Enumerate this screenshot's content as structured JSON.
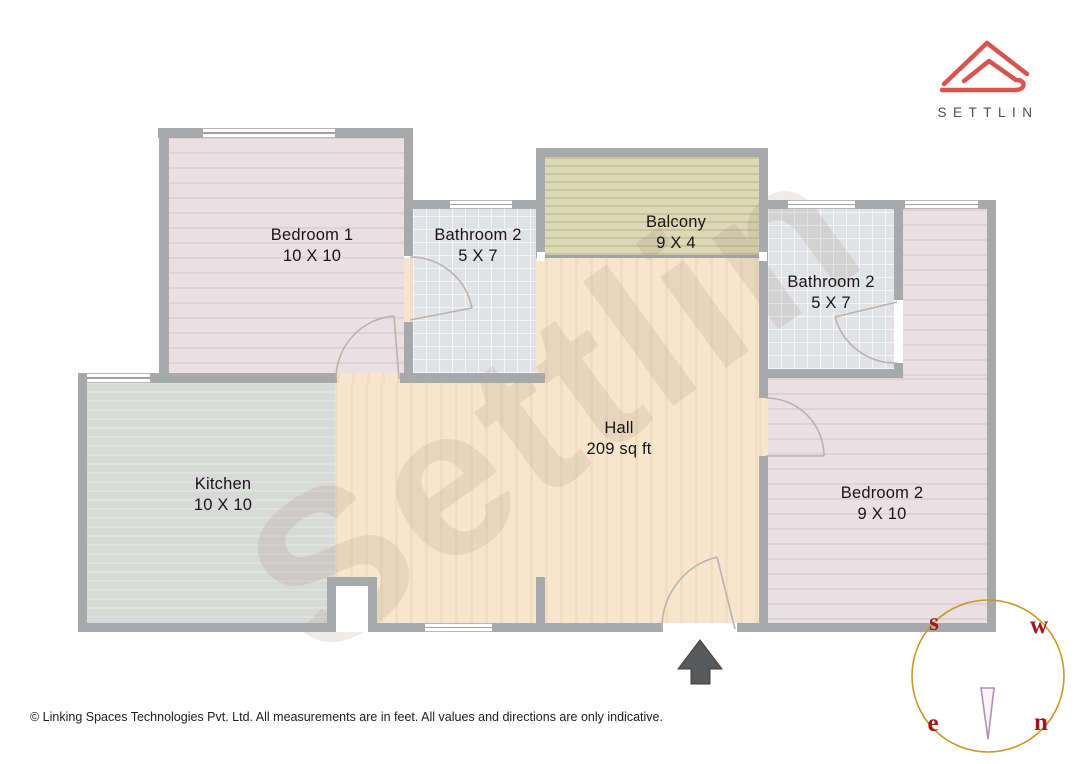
{
  "logo": {
    "brand": "SETTLIN"
  },
  "rooms": {
    "bedroom1": {
      "name": "Bedroom 1",
      "dims": "10 X 10"
    },
    "bathroom_left": {
      "name": "Bathroom 2",
      "dims": "5 X 7"
    },
    "balcony": {
      "name": "Balcony",
      "dims": "9 X 4"
    },
    "bathroom_right": {
      "name": "Bathroom 2",
      "dims": "5 X 7"
    },
    "hall": {
      "name": "Hall",
      "dims": "209 sq ft"
    },
    "bedroom2": {
      "name": "Bedroom 2",
      "dims": "9 X 10"
    },
    "kitchen": {
      "name": "Kitchen",
      "dims": "10 X 10"
    }
  },
  "compass": {
    "top_left": "s",
    "top_right": "w",
    "bottom_left": "e",
    "bottom_right": "n"
  },
  "watermark": "Settlin",
  "footer": {
    "copyright": "© Linking Spaces Technologies Pvt. Ltd. All measurements are in feet. All values and directions are only indicative."
  },
  "colors": {
    "brand_red": "#d9534f",
    "wall": "#a7a9ab",
    "hall_floor": "#f8e5cd",
    "bedroom_floor": "#eadfe2",
    "bathroom_floor": "#e0e2e6",
    "kitchen_floor": "#d8dad8",
    "balcony_floor": "#ddd8b5",
    "compass_ring": "#c8982c",
    "compass_letter": "#9b1b1b",
    "arrow": "#58595b"
  }
}
